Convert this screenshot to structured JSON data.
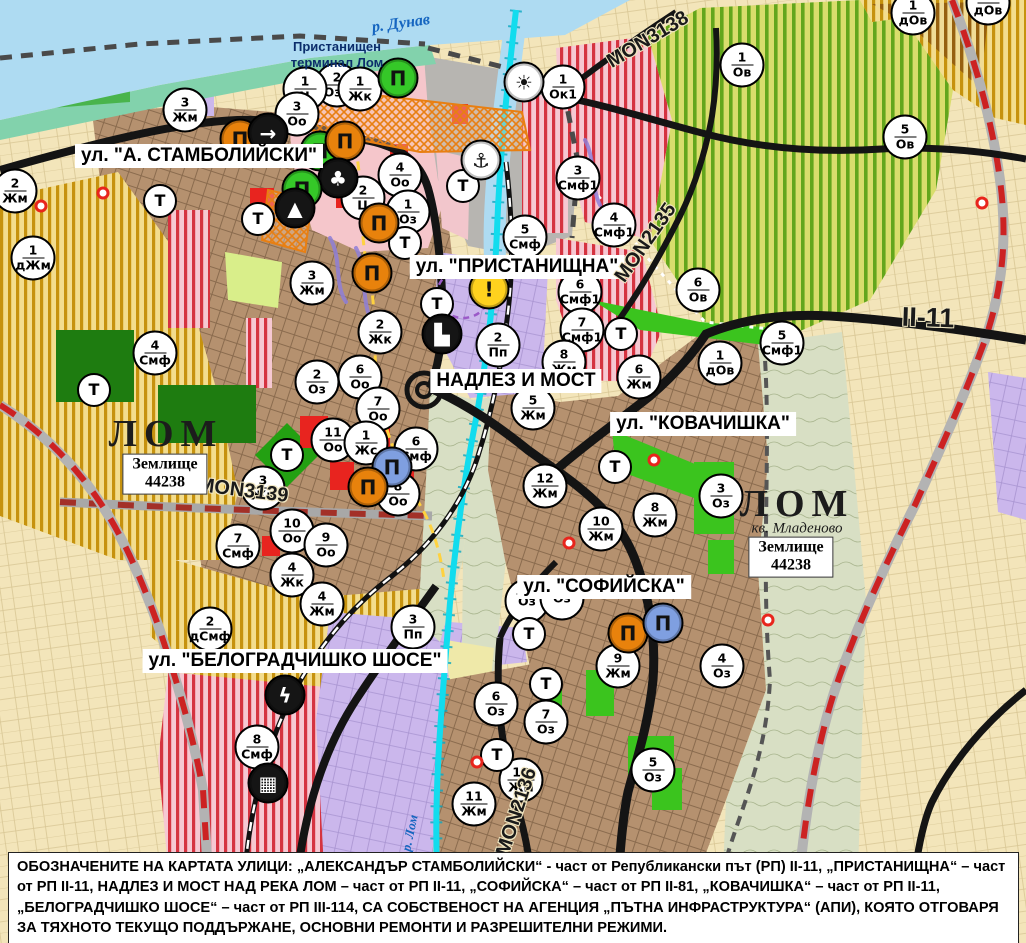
{
  "note": {
    "text": "ОБОЗНАЧЕНИТЕ НА КАРТАТА УЛИЦИ: „АЛЕКСАНДЪР СТАМБОЛИЙСКИ“ - част от Републикански път (РП) II-11, „ПРИСТАНИЩНА“ – част от РП II-11, НАДЛЕЗ И МОСТ НАД РЕКА ЛОМ – част от РП II-11, „СОФИЙСКА“ – част от РП II-81, „КОВАЧИШКА“ – част от РП II-11, „БЕЛОГРАДЧИШКО ШОСЕ“ – част от РП III-114, СА СОБСТВЕНОСТ НА АГЕНЦИЯ „ПЪТНА ИНФРАСТРУКТУРА“ (АПИ), КОЯТО ОТГОВАРЯ ЗА ТЯХНОТО ТЕКУЩО ПОДДЪРЖАНЕ, ОСНОВНИ РЕМОНТИ И РАЗРЕШИТЕЛНИ РЕЖИМИ."
  },
  "labels": [
    {
      "name": "street-label-stamboliyski",
      "type": "street",
      "text": "ул. \"А. СТАМБОЛИЙСКИ\"",
      "x": 199,
      "y": 156
    },
    {
      "name": "street-label-pristanishtna",
      "type": "street",
      "text": "ул. \"ПРИСТАНИЩНА\"",
      "x": 517,
      "y": 267
    },
    {
      "name": "street-label-nadlez-i-most",
      "type": "street",
      "text": "НАДЛЕЗ И МОСТ",
      "x": 516,
      "y": 381
    },
    {
      "name": "street-label-kovachishka",
      "type": "street",
      "text": "ул. \"КОВАЧИШКА\"",
      "x": 703,
      "y": 424
    },
    {
      "name": "street-label-sofiyska",
      "type": "street",
      "text": "ул. \"СОФИЙСКА\"",
      "x": 604,
      "y": 587
    },
    {
      "name": "street-label-belogradchishko-shose",
      "type": "street",
      "text": "ул. \"БЕЛОГРАДЧИШКО ШОСЕ\"",
      "x": 295,
      "y": 661
    },
    {
      "name": "road-ref-mon3139",
      "type": "road",
      "text": "MON3139",
      "x": 243,
      "y": 491,
      "rotate": 7
    },
    {
      "name": "road-ref-mon3138",
      "type": "road",
      "text": "MON3138",
      "x": 648,
      "y": 40,
      "rotate": -31
    },
    {
      "name": "road-ref-mon2135",
      "type": "road",
      "text": "MON2135",
      "x": 646,
      "y": 243,
      "rotate": -55
    },
    {
      "name": "road-ref-mon2136",
      "type": "road",
      "text": "MON2136",
      "x": 517,
      "y": 812,
      "rotate": -72
    },
    {
      "name": "road-ref-ii-11",
      "type": "road xl",
      "text": "II-11",
      "x": 928,
      "y": 318,
      "rotate": 2
    },
    {
      "name": "river-label-danube",
      "type": "water",
      "text": "р. Дунав",
      "x": 401,
      "y": 24,
      "rotate": -8
    },
    {
      "name": "river-label-lom",
      "type": "water sm",
      "text": "р. Лом",
      "x": 410,
      "y": 833,
      "rotate": -78
    },
    {
      "name": "city-label-lom-west",
      "type": "city",
      "text": "ЛОМ",
      "x": 166,
      "y": 434
    },
    {
      "name": "city-label-lom-mladenovo",
      "type": "city",
      "text": "ЛОМ",
      "x": 797,
      "y": 504
    },
    {
      "name": "district-label-mladenovo",
      "type": "sub",
      "text": "кв. Младеново",
      "x": 797,
      "y": 529
    },
    {
      "name": "landparcel-label-west",
      "type": "box",
      "text": "Землище\n44238",
      "x": 165,
      "y": 474
    },
    {
      "name": "landparcel-label-east",
      "type": "box",
      "text": "Землище\n44238",
      "x": 791,
      "y": 557
    },
    {
      "name": "place-label-port-terminal",
      "type": "place",
      "text": "Пристанищен\nтерминал Лом",
      "x": 337,
      "y": 55
    }
  ],
  "zone_markers": [
    {
      "num": "2",
      "code": "Ози",
      "x": 337,
      "y": 85
    },
    {
      "num": "1",
      "code": "Ц",
      "x": 305,
      "y": 89
    },
    {
      "num": "1",
      "code": "Жк",
      "x": 360,
      "y": 89
    },
    {
      "num": "3",
      "code": "Оо",
      "x": 297,
      "y": 114
    },
    {
      "num": "3",
      "code": "Жм",
      "x": 185,
      "y": 110
    },
    {
      "num": "2",
      "code": "Жм",
      "x": 15,
      "y": 191
    },
    {
      "num": "1",
      "code": "дЖм",
      "x": 33,
      "y": 258
    },
    {
      "num": "4",
      "code": "Оо",
      "x": 400,
      "y": 175
    },
    {
      "num": "2",
      "code": "Ц",
      "x": 363,
      "y": 198
    },
    {
      "num": "1",
      "code": "Оз",
      "x": 408,
      "y": 212
    },
    {
      "num": "3",
      "code": "Жм",
      "x": 312,
      "y": 283
    },
    {
      "num": "2",
      "code": "Жк",
      "x": 380,
      "y": 332
    },
    {
      "num": "2",
      "code": "Оз",
      "x": 317,
      "y": 382
    },
    {
      "num": "6",
      "code": "Оо",
      "x": 360,
      "y": 377
    },
    {
      "num": "7",
      "code": "Оо",
      "x": 378,
      "y": 409
    },
    {
      "num": "11",
      "code": "Оо",
      "x": 333,
      "y": 440
    },
    {
      "num": "1",
      "code": "Жс",
      "x": 366,
      "y": 443
    },
    {
      "num": "6",
      "code": "Смф",
      "x": 416,
      "y": 449
    },
    {
      "num": "8",
      "code": "Оо",
      "x": 398,
      "y": 494
    },
    {
      "num": "3",
      "code": "Жк",
      "x": 263,
      "y": 488
    },
    {
      "num": "10",
      "code": "Оо",
      "x": 292,
      "y": 531
    },
    {
      "num": "9",
      "code": "Оо",
      "x": 326,
      "y": 545
    },
    {
      "num": "4",
      "code": "Жк",
      "x": 292,
      "y": 575
    },
    {
      "num": "4",
      "code": "Жм",
      "x": 322,
      "y": 604
    },
    {
      "num": "3",
      "code": "Пп",
      "x": 413,
      "y": 627
    },
    {
      "num": "2",
      "code": "дСмф",
      "x": 210,
      "y": 629
    },
    {
      "num": "7",
      "code": "Смф",
      "x": 238,
      "y": 546
    },
    {
      "num": "4",
      "code": "Смф",
      "x": 155,
      "y": 353
    },
    {
      "num": "8",
      "code": "Смф",
      "x": 257,
      "y": 747
    },
    {
      "num": "5",
      "code": "Смф",
      "x": 525,
      "y": 237
    },
    {
      "num": "3",
      "code": "Смф1",
      "x": 578,
      "y": 178
    },
    {
      "num": "1",
      "code": "Ок1",
      "x": 563,
      "y": 87
    },
    {
      "num": "4",
      "code": "Смф1",
      "x": 614,
      "y": 225
    },
    {
      "num": "6",
      "code": "Смф1",
      "x": 580,
      "y": 292
    },
    {
      "num": "7",
      "code": "Смф1",
      "x": 582,
      "y": 330
    },
    {
      "num": "8",
      "code": "Жм",
      "x": 564,
      "y": 362
    },
    {
      "num": "2",
      "code": "Пп",
      "x": 498,
      "y": 345
    },
    {
      "num": "5",
      "code": "Жм",
      "x": 533,
      "y": 408
    },
    {
      "num": "12",
      "code": "Жм",
      "x": 545,
      "y": 486
    },
    {
      "num": "8",
      "code": "Жм",
      "x": 655,
      "y": 515
    },
    {
      "num": "6",
      "code": "Жм",
      "x": 639,
      "y": 377
    },
    {
      "num": "3",
      "code": "Оз",
      "x": 721,
      "y": 496
    },
    {
      "num": "10",
      "code": "Жм",
      "x": 601,
      "y": 529
    },
    {
      "num": "9",
      "code": "Жм",
      "x": 618,
      "y": 666
    },
    {
      "num": "4",
      "code": "Оз",
      "x": 722,
      "y": 666
    },
    {
      "num": "6",
      "code": "Оз",
      "x": 496,
      "y": 704
    },
    {
      "num": "7",
      "code": "Оз",
      "x": 546,
      "y": 722
    },
    {
      "num": "5",
      "code": "Оз",
      "x": 653,
      "y": 770
    },
    {
      "num": "10",
      "code": "Жм",
      "x": 521,
      "y": 780
    },
    {
      "num": "11",
      "code": "Жм",
      "x": 474,
      "y": 804
    },
    {
      "num": "1",
      "code": "дОв",
      "x": 913,
      "y": 13
    },
    {
      "num": "1",
      "code": "дОв",
      "x": 988,
      "y": 3
    },
    {
      "num": "1",
      "code": "Ов",
      "x": 742,
      "y": 65
    },
    {
      "num": "5",
      "code": "Ов",
      "x": 905,
      "y": 137
    },
    {
      "num": "6",
      "code": "Ов",
      "x": 698,
      "y": 290
    },
    {
      "num": "5",
      "code": "Смф1",
      "x": 782,
      "y": 343
    },
    {
      "num": "1",
      "code": "дОв",
      "x": 720,
      "y": 363
    },
    {
      "num": "",
      "code": "Оз",
      "x": 527,
      "y": 601
    },
    {
      "num": "",
      "code": "Оз",
      "x": 562,
      "y": 598
    }
  ],
  "point_markers": [
    {
      "name": "t-marker",
      "type": "t",
      "glyph": "Т",
      "x": 160,
      "y": 201
    },
    {
      "name": "t-marker",
      "type": "t",
      "glyph": "Т",
      "x": 258,
      "y": 219
    },
    {
      "name": "t-marker",
      "type": "t",
      "glyph": "Т",
      "x": 287,
      "y": 455
    },
    {
      "name": "t-marker",
      "type": "t",
      "glyph": "Т",
      "x": 405,
      "y": 243
    },
    {
      "name": "t-marker",
      "type": "t",
      "glyph": "Т",
      "x": 437,
      "y": 304
    },
    {
      "name": "t-marker",
      "type": "t",
      "glyph": "Т",
      "x": 463,
      "y": 186
    },
    {
      "name": "t-marker",
      "type": "t",
      "glyph": "Т",
      "x": 621,
      "y": 334
    },
    {
      "name": "t-marker",
      "type": "t",
      "glyph": "Т",
      "x": 615,
      "y": 467
    },
    {
      "name": "t-marker",
      "type": "t",
      "glyph": "Т",
      "x": 529,
      "y": 634
    },
    {
      "name": "t-marker",
      "type": "t",
      "glyph": "Т",
      "x": 546,
      "y": 684
    },
    {
      "name": "t-marker",
      "type": "t",
      "glyph": "Т",
      "x": 94,
      "y": 390
    },
    {
      "name": "t-marker",
      "type": "t",
      "glyph": "Т",
      "x": 497,
      "y": 755
    },
    {
      "name": "port-facility-icon",
      "type": "ico",
      "glyph": "Π",
      "color": "#35c828",
      "fg": "#111",
      "x": 398,
      "y": 78
    },
    {
      "name": "heritage-icon",
      "type": "ico",
      "glyph": "Π",
      "color": "#e8820c",
      "fg": "#111",
      "x": 240,
      "y": 139
    },
    {
      "name": "arrow-icon",
      "type": "ico",
      "glyph": "→",
      "color": "#151515",
      "fg": "#fff",
      "x": 268,
      "y": 133
    },
    {
      "name": "heritage-icon",
      "type": "ico",
      "glyph": "Π",
      "color": "#35c828",
      "fg": "#111",
      "x": 320,
      "y": 151
    },
    {
      "name": "heritage-icon",
      "type": "ico",
      "glyph": "Π",
      "color": "#e8820c",
      "fg": "#111",
      "x": 345,
      "y": 141
    },
    {
      "name": "club-icon",
      "type": "ico",
      "glyph": "♣",
      "color": "#151515",
      "fg": "#fff",
      "x": 338,
      "y": 178
    },
    {
      "name": "heritage-icon",
      "type": "ico",
      "glyph": "Π",
      "color": "#35c828",
      "fg": "#111",
      "x": 302,
      "y": 189
    },
    {
      "name": "triangle-icon",
      "type": "ico",
      "glyph": "▲",
      "color": "#151515",
      "fg": "#fff",
      "x": 295,
      "y": 208
    },
    {
      "name": "heritage-icon",
      "type": "ico",
      "glyph": "Π",
      "color": "#e8820c",
      "fg": "#111",
      "x": 379,
      "y": 223
    },
    {
      "name": "heritage-icon",
      "type": "ico",
      "glyph": "Π",
      "color": "#e8820c",
      "fg": "#111",
      "x": 372,
      "y": 273
    },
    {
      "name": "anchor-icon",
      "type": "ico",
      "glyph": "⚓",
      "color": "#fff",
      "fg": "#111",
      "x": 481,
      "y": 160
    },
    {
      "name": "sun-icon",
      "type": "ico",
      "glyph": "☀",
      "color": "#fff",
      "fg": "#111",
      "x": 524,
      "y": 82
    },
    {
      "name": "warning-icon",
      "type": "ico",
      "glyph": "!",
      "color": "#ffd21e",
      "fg": "#111",
      "x": 489,
      "y": 289
    },
    {
      "name": "truck-icon",
      "type": "ico",
      "glyph": "▙",
      "color": "#151515",
      "fg": "#fff",
      "x": 442,
      "y": 334
    },
    {
      "name": "industry-icon",
      "type": "ico",
      "glyph": "Π",
      "color": "#7f9fe0",
      "fg": "#111",
      "x": 392,
      "y": 467
    },
    {
      "name": "heritage-icon",
      "type": "ico",
      "glyph": "Π",
      "color": "#e8820c",
      "fg": "#111",
      "x": 368,
      "y": 487
    },
    {
      "name": "heritage-icon",
      "type": "ico",
      "glyph": "Π",
      "color": "#e8820c",
      "fg": "#111",
      "x": 628,
      "y": 633
    },
    {
      "name": "industry-icon",
      "type": "ico",
      "glyph": "Π",
      "color": "#7f9fe0",
      "fg": "#111",
      "x": 663,
      "y": 623
    },
    {
      "name": "lightning-icon",
      "type": "ico",
      "glyph": "ϟ",
      "color": "#151515",
      "fg": "#fff",
      "x": 285,
      "y": 695
    },
    {
      "name": "railway-crossing-icon",
      "type": "ico",
      "glyph": "▦",
      "color": "#151515",
      "fg": "#fff",
      "x": 268,
      "y": 783
    },
    {
      "name": "point-of-interest-dot",
      "type": "dot",
      "glyph": "",
      "x": 103,
      "y": 193
    },
    {
      "name": "point-of-interest-dot",
      "type": "dot",
      "glyph": "",
      "x": 41,
      "y": 206
    },
    {
      "name": "point-of-interest-dot",
      "type": "dot",
      "glyph": "",
      "x": 569,
      "y": 543
    },
    {
      "name": "point-of-interest-dot",
      "type": "dot",
      "glyph": "",
      "x": 654,
      "y": 460
    },
    {
      "name": "point-of-interest-dot",
      "type": "dot",
      "glyph": "",
      "x": 477,
      "y": 762
    },
    {
      "name": "point-of-interest-dot",
      "type": "dot",
      "glyph": "",
      "x": 768,
      "y": 620
    },
    {
      "name": "point-of-interest-dot",
      "type": "dot",
      "glyph": "",
      "x": 982,
      "y": 203
    }
  ],
  "colors": {
    "water": "#aedbf2",
    "river_canal": "#12dcee",
    "shore": "#82d2ac",
    "urban_zone": "#b5916f",
    "gold_zone_stripe": "#c6920e",
    "vineyard_stripe": "#63a61c",
    "red_zone_stripe": "#d53340",
    "purple_zone": "#cbb7ec",
    "park_green": "#3bc41e",
    "dark_green": "#1e7c10",
    "main_road": "#141414",
    "republican_road_dash": "#cc2222",
    "terminal_outline": "#e87f12"
  }
}
